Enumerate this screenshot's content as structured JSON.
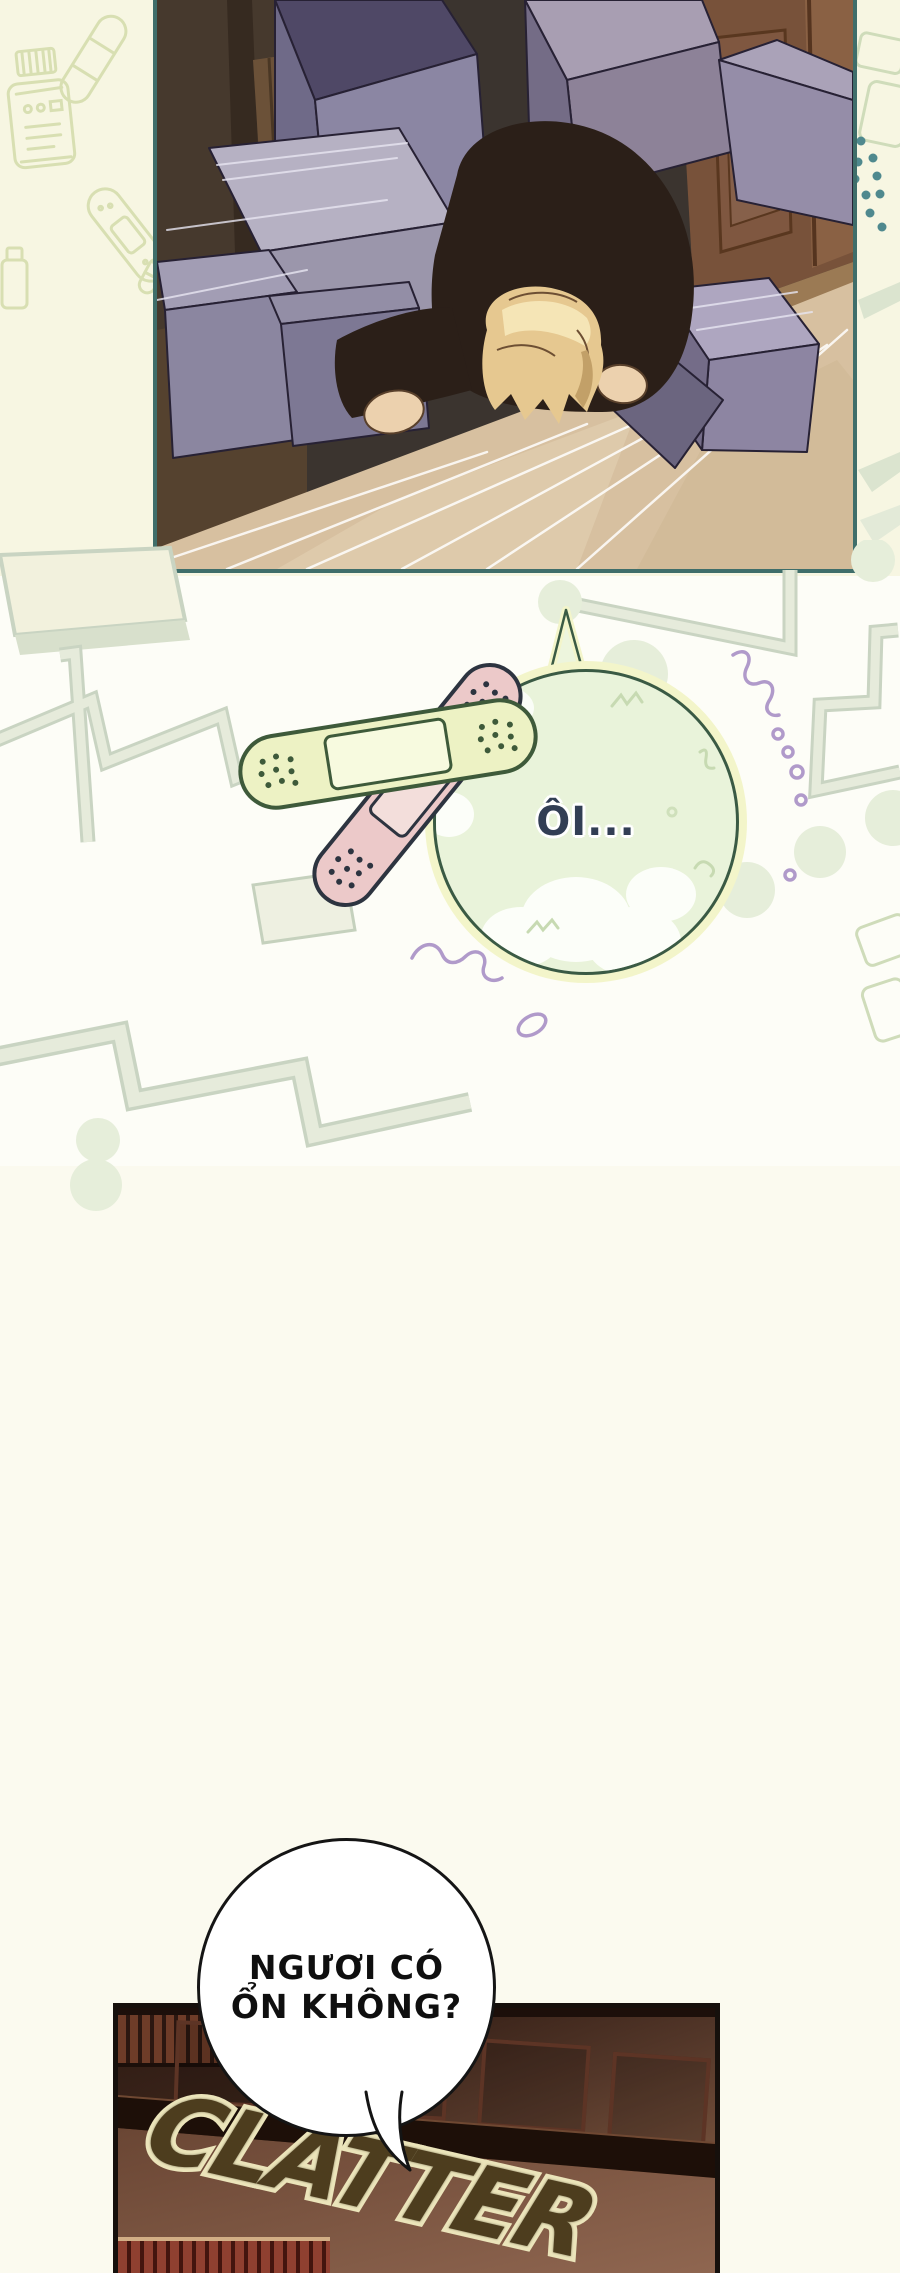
{
  "page": {
    "width": 900,
    "height": 2273
  },
  "palette": {
    "bg-top": "#f7f6e2",
    "bg-mid": "#fdfdf7",
    "bg-bottom": "#fbfaef",
    "panel-border-teal": "#3f6e6a",
    "panel-border-black": "#16100c",
    "zigzag-sage": "#c9d4c2",
    "zigzag-sage-light": "#e6ebdb",
    "dot-green": "#e6eeda",
    "dot-teal": "#4f898e",
    "squiggle-purple": "#b09aca",
    "squiggle-green": "#c7dab2",
    "bandaid-yellow": "#edf2c4",
    "bandaid-yellow-outline": "#3e5a3a",
    "bandaid-pink": "#ecc9c9",
    "bandaid-pink-outline": "#2d3440",
    "bubble-green-fill": "#e9f3da",
    "bubble-green-outline": "#3a5a44",
    "bubble-green-halo": "#f3f5ca",
    "bubble-text-navy": "#323e54",
    "bubble-white-fill": "#ffffff",
    "bubble-white-outline": "#151515",
    "bubble-white-text": "#0f0f0f",
    "sfx-fill": "#4d3d1e",
    "sfx-outline": "#ebe4ba",
    "box-purple": "#8b86a3",
    "floor-beige": "#d7c0a0",
    "hair-blonde": "#e6c890",
    "door-brown": "#78523a"
  },
  "speech_bubbles": {
    "oi": {
      "text": "ÔI..."
    },
    "question": {
      "line1": "NGƯƠI CÓ",
      "line2": "ỔN KHÔNG?"
    }
  },
  "sfx": {
    "clatter": "CLATTER"
  },
  "background_icons": [
    "pill-bottle-icon",
    "bandage-icon",
    "bandage-diagonal-icon",
    "small-bottle-icon",
    "capsule-icon",
    "teal-dots",
    "zigzag-pattern"
  ]
}
